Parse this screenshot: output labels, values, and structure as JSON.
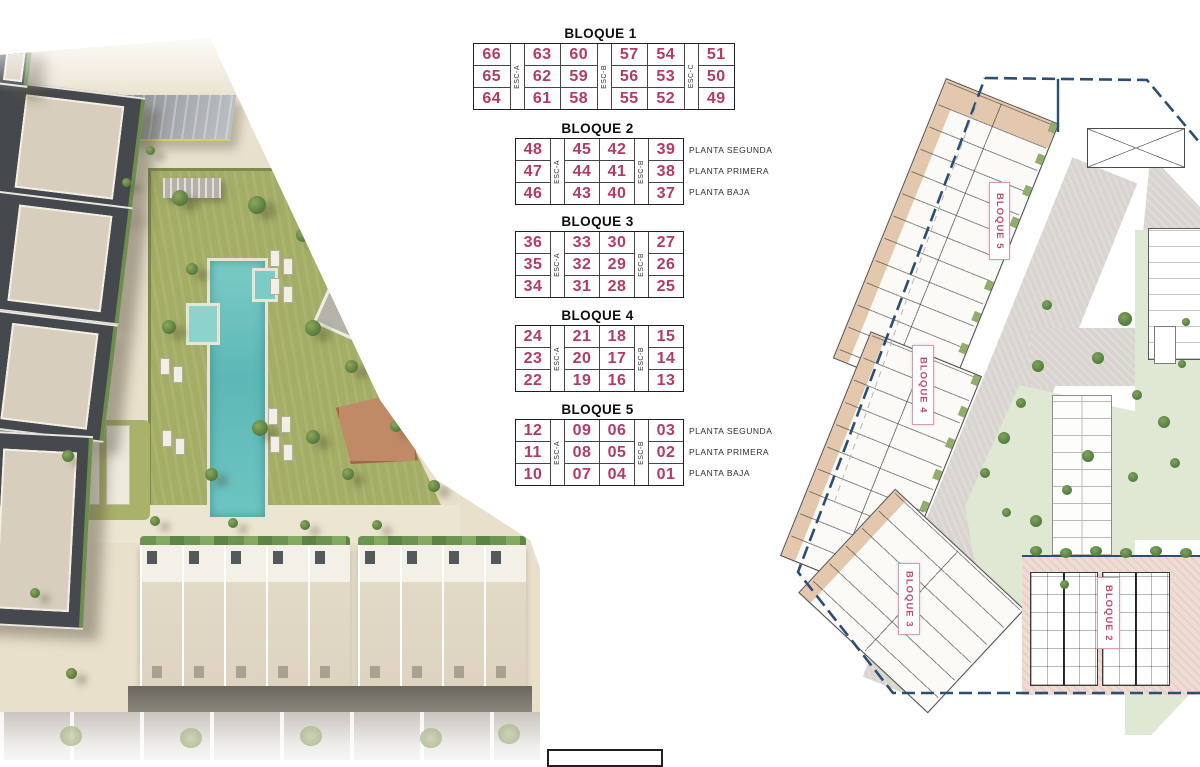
{
  "colors": {
    "unit_number_pink": "#b43a64",
    "block_label_pink": "#c14a6a",
    "boundary_navy": "#2c4e72",
    "table_border": "#1f1f1f",
    "sand": "#e8e0cb",
    "grass": "#a3ad66",
    "pool": "#6ec5c1",
    "road_gray": "#d8d5d0",
    "building_dark": "#45494d",
    "terrace_beige": "#e4c8ae",
    "block2_fill": "#f0dcd2",
    "garden_light": "#dfe8d2"
  },
  "tables": [
    {
      "title": "BLOQUE 1",
      "esc_labels": [
        "ESC-A",
        "ESC-B",
        "ESC-C"
      ],
      "col_groups": [
        1,
        2,
        2,
        1
      ],
      "rows": [
        [
          "66",
          "63",
          "60",
          "57",
          "54",
          "51"
        ],
        [
          "65",
          "62",
          "59",
          "56",
          "53",
          "50"
        ],
        [
          "64",
          "61",
          "58",
          "55",
          "52",
          "49"
        ]
      ],
      "floor_labels": []
    },
    {
      "title": "BLOQUE 2",
      "esc_labels": [
        "ESC-A",
        "ESC-B"
      ],
      "col_groups": [
        1,
        2,
        1
      ],
      "rows": [
        [
          "48",
          "45",
          "42",
          "39"
        ],
        [
          "47",
          "44",
          "41",
          "38"
        ],
        [
          "46",
          "43",
          "40",
          "37"
        ]
      ],
      "floor_labels": [
        "PLANTA SEGUNDA",
        "PLANTA PRIMERA",
        "PLANTA BAJA"
      ]
    },
    {
      "title": "BLOQUE 3",
      "esc_labels": [
        "ESC-A",
        "ESC-B"
      ],
      "col_groups": [
        1,
        2,
        1
      ],
      "rows": [
        [
          "36",
          "33",
          "30",
          "27"
        ],
        [
          "35",
          "32",
          "29",
          "26"
        ],
        [
          "34",
          "31",
          "28",
          "25"
        ]
      ],
      "floor_labels": []
    },
    {
      "title": "BLOQUE 4",
      "esc_labels": [
        "ESC-A",
        "ESC-B"
      ],
      "col_groups": [
        1,
        2,
        1
      ],
      "rows": [
        [
          "24",
          "21",
          "18",
          "15"
        ],
        [
          "23",
          "20",
          "17",
          "14"
        ],
        [
          "22",
          "19",
          "16",
          "13"
        ]
      ],
      "floor_labels": []
    },
    {
      "title": "BLOQUE 5",
      "esc_labels": [
        "ESC-A",
        "ESC-B"
      ],
      "col_groups": [
        1,
        2,
        1
      ],
      "rows": [
        [
          "12",
          "09",
          "06",
          "03"
        ],
        [
          "11",
          "08",
          "05",
          "02"
        ],
        [
          "10",
          "07",
          "04",
          "01"
        ]
      ],
      "floor_labels": [
        "PLANTA SEGUNDA",
        "PLANTA PRIMERA",
        "PLANTA BAJA"
      ]
    }
  ],
  "site_plan": {
    "block_labels": [
      "BLOQUE 5",
      "BLOQUE 4",
      "BLOQUE 3",
      "BLOQUE 2"
    ]
  }
}
